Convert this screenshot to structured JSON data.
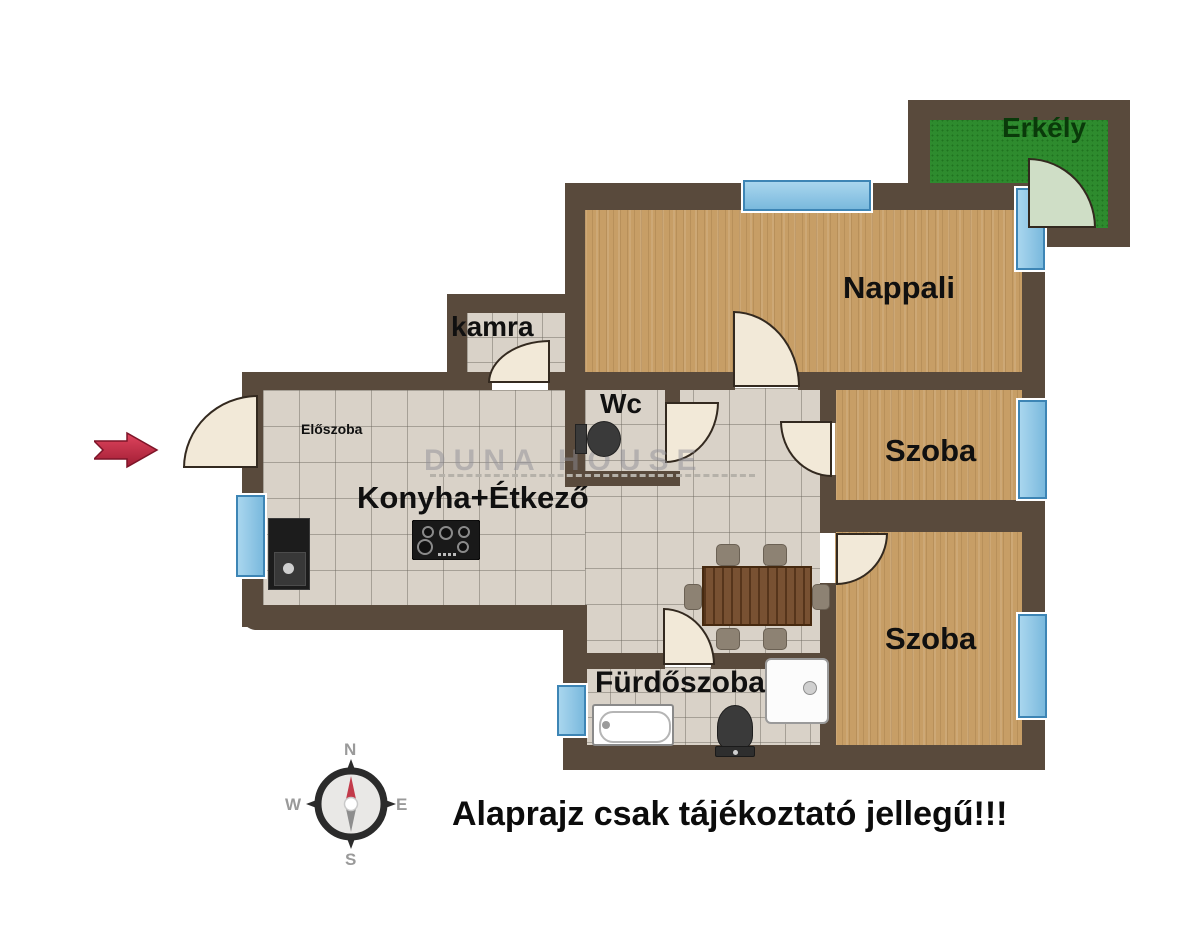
{
  "rooms": {
    "erkely": "Erkély",
    "nappali": "Nappali",
    "kamra": "kamra",
    "wc": "Wc",
    "eloszoba": "Előszoba",
    "konyha_etkezo": "Konyha+Étkező",
    "szoba1": "Szoba",
    "szoba2": "Szoba",
    "furdoszoba": "Fürdőszoba"
  },
  "compass": {
    "n": "N",
    "e": "E",
    "s": "S",
    "w": "W"
  },
  "disclaimer": "Alaprajz csak tájékoztató jellegű!!!",
  "watermark": "DUNA HOUSE",
  "colors": {
    "wall": "#594a3c",
    "wood": "#c79e66",
    "tile": "#d9d2c8",
    "balcony_green": "#2e8b2e",
    "window_blue": "#7ab9dd",
    "door": "#f2e9d8",
    "arrow_red": "#c72643"
  }
}
